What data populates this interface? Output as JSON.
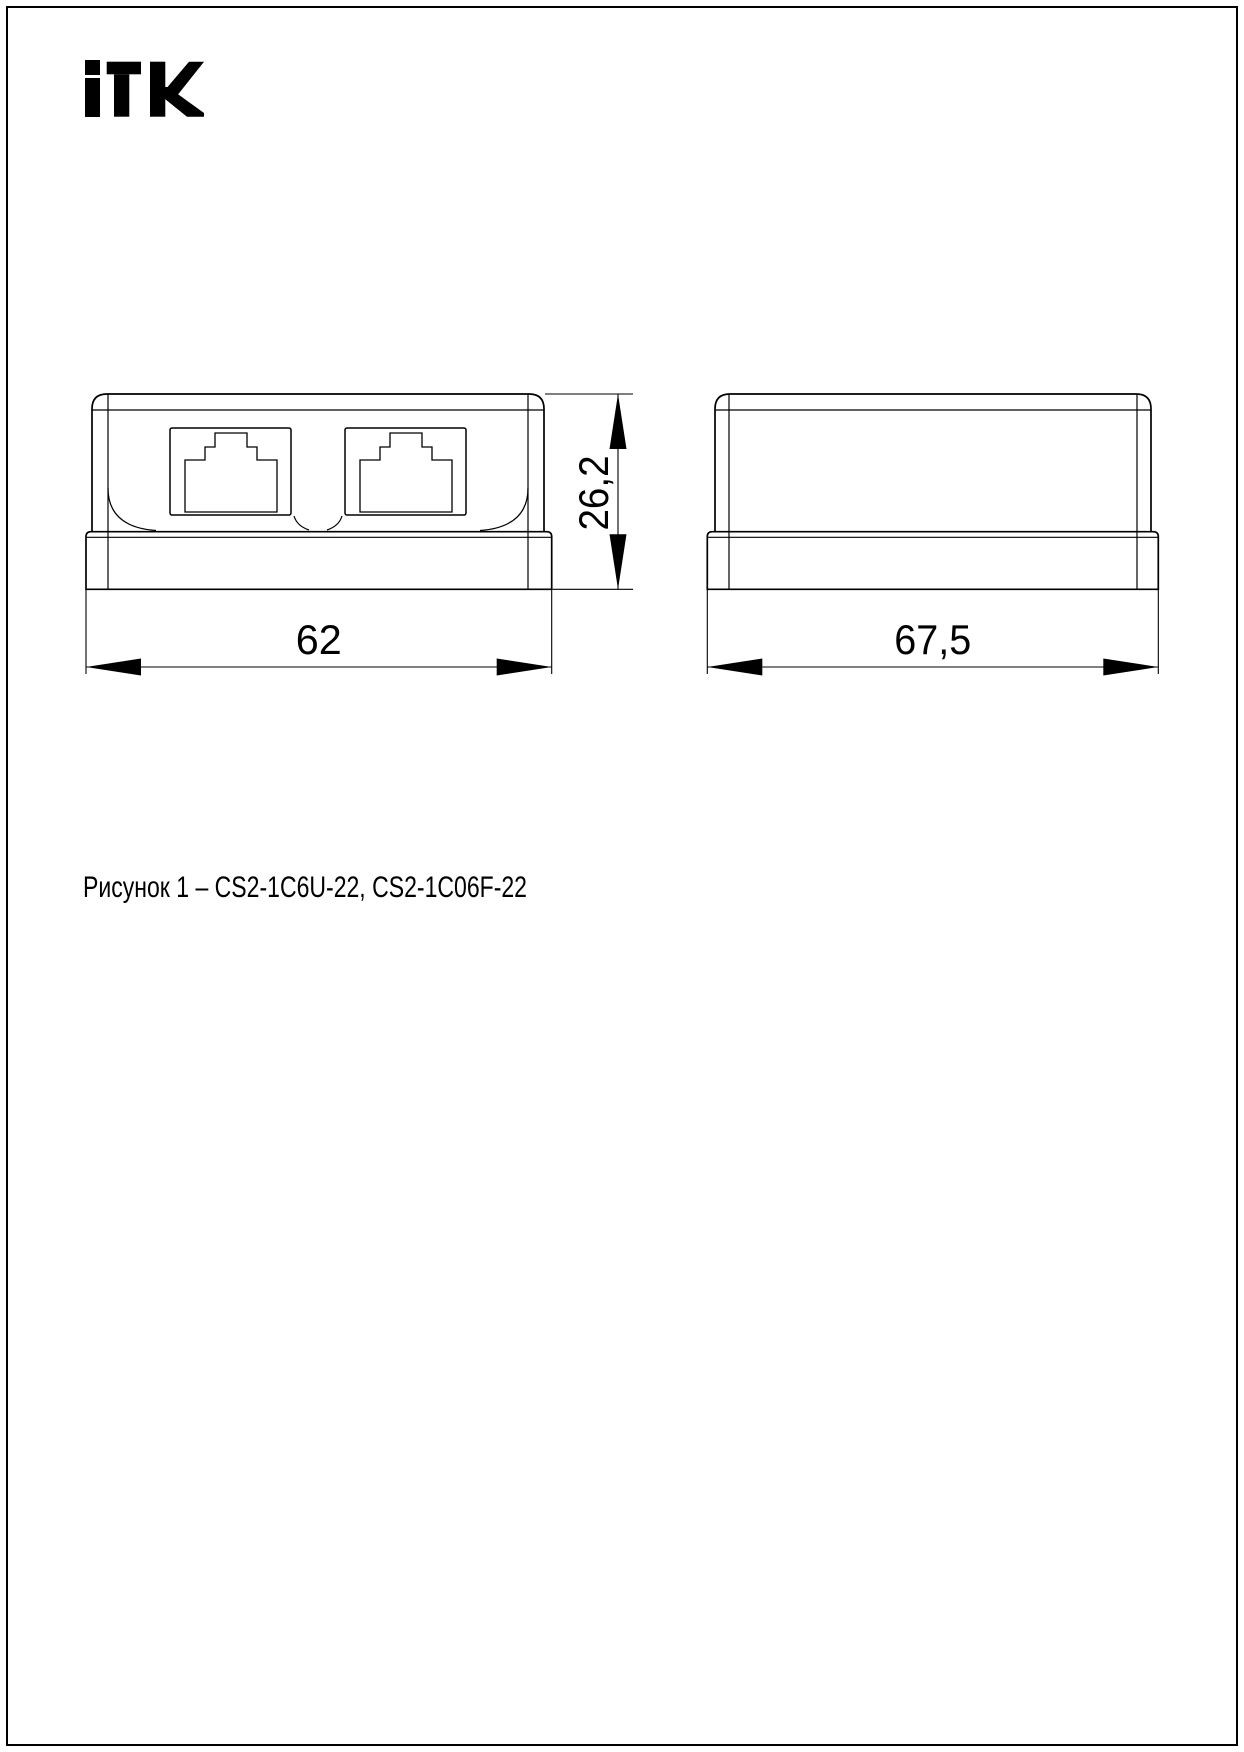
{
  "page": {
    "background": "#ffffff",
    "border_color": "#000000",
    "line_color": "#000000"
  },
  "logo": {
    "brand": "iTK",
    "color": "#000000"
  },
  "drawing": {
    "caption": "Рисунок 1 – CS2-1C6U-22, CS2-1C06F-22",
    "dimensions": {
      "front_width": "62",
      "front_height": "26,2",
      "side_depth": "67,5"
    }
  }
}
